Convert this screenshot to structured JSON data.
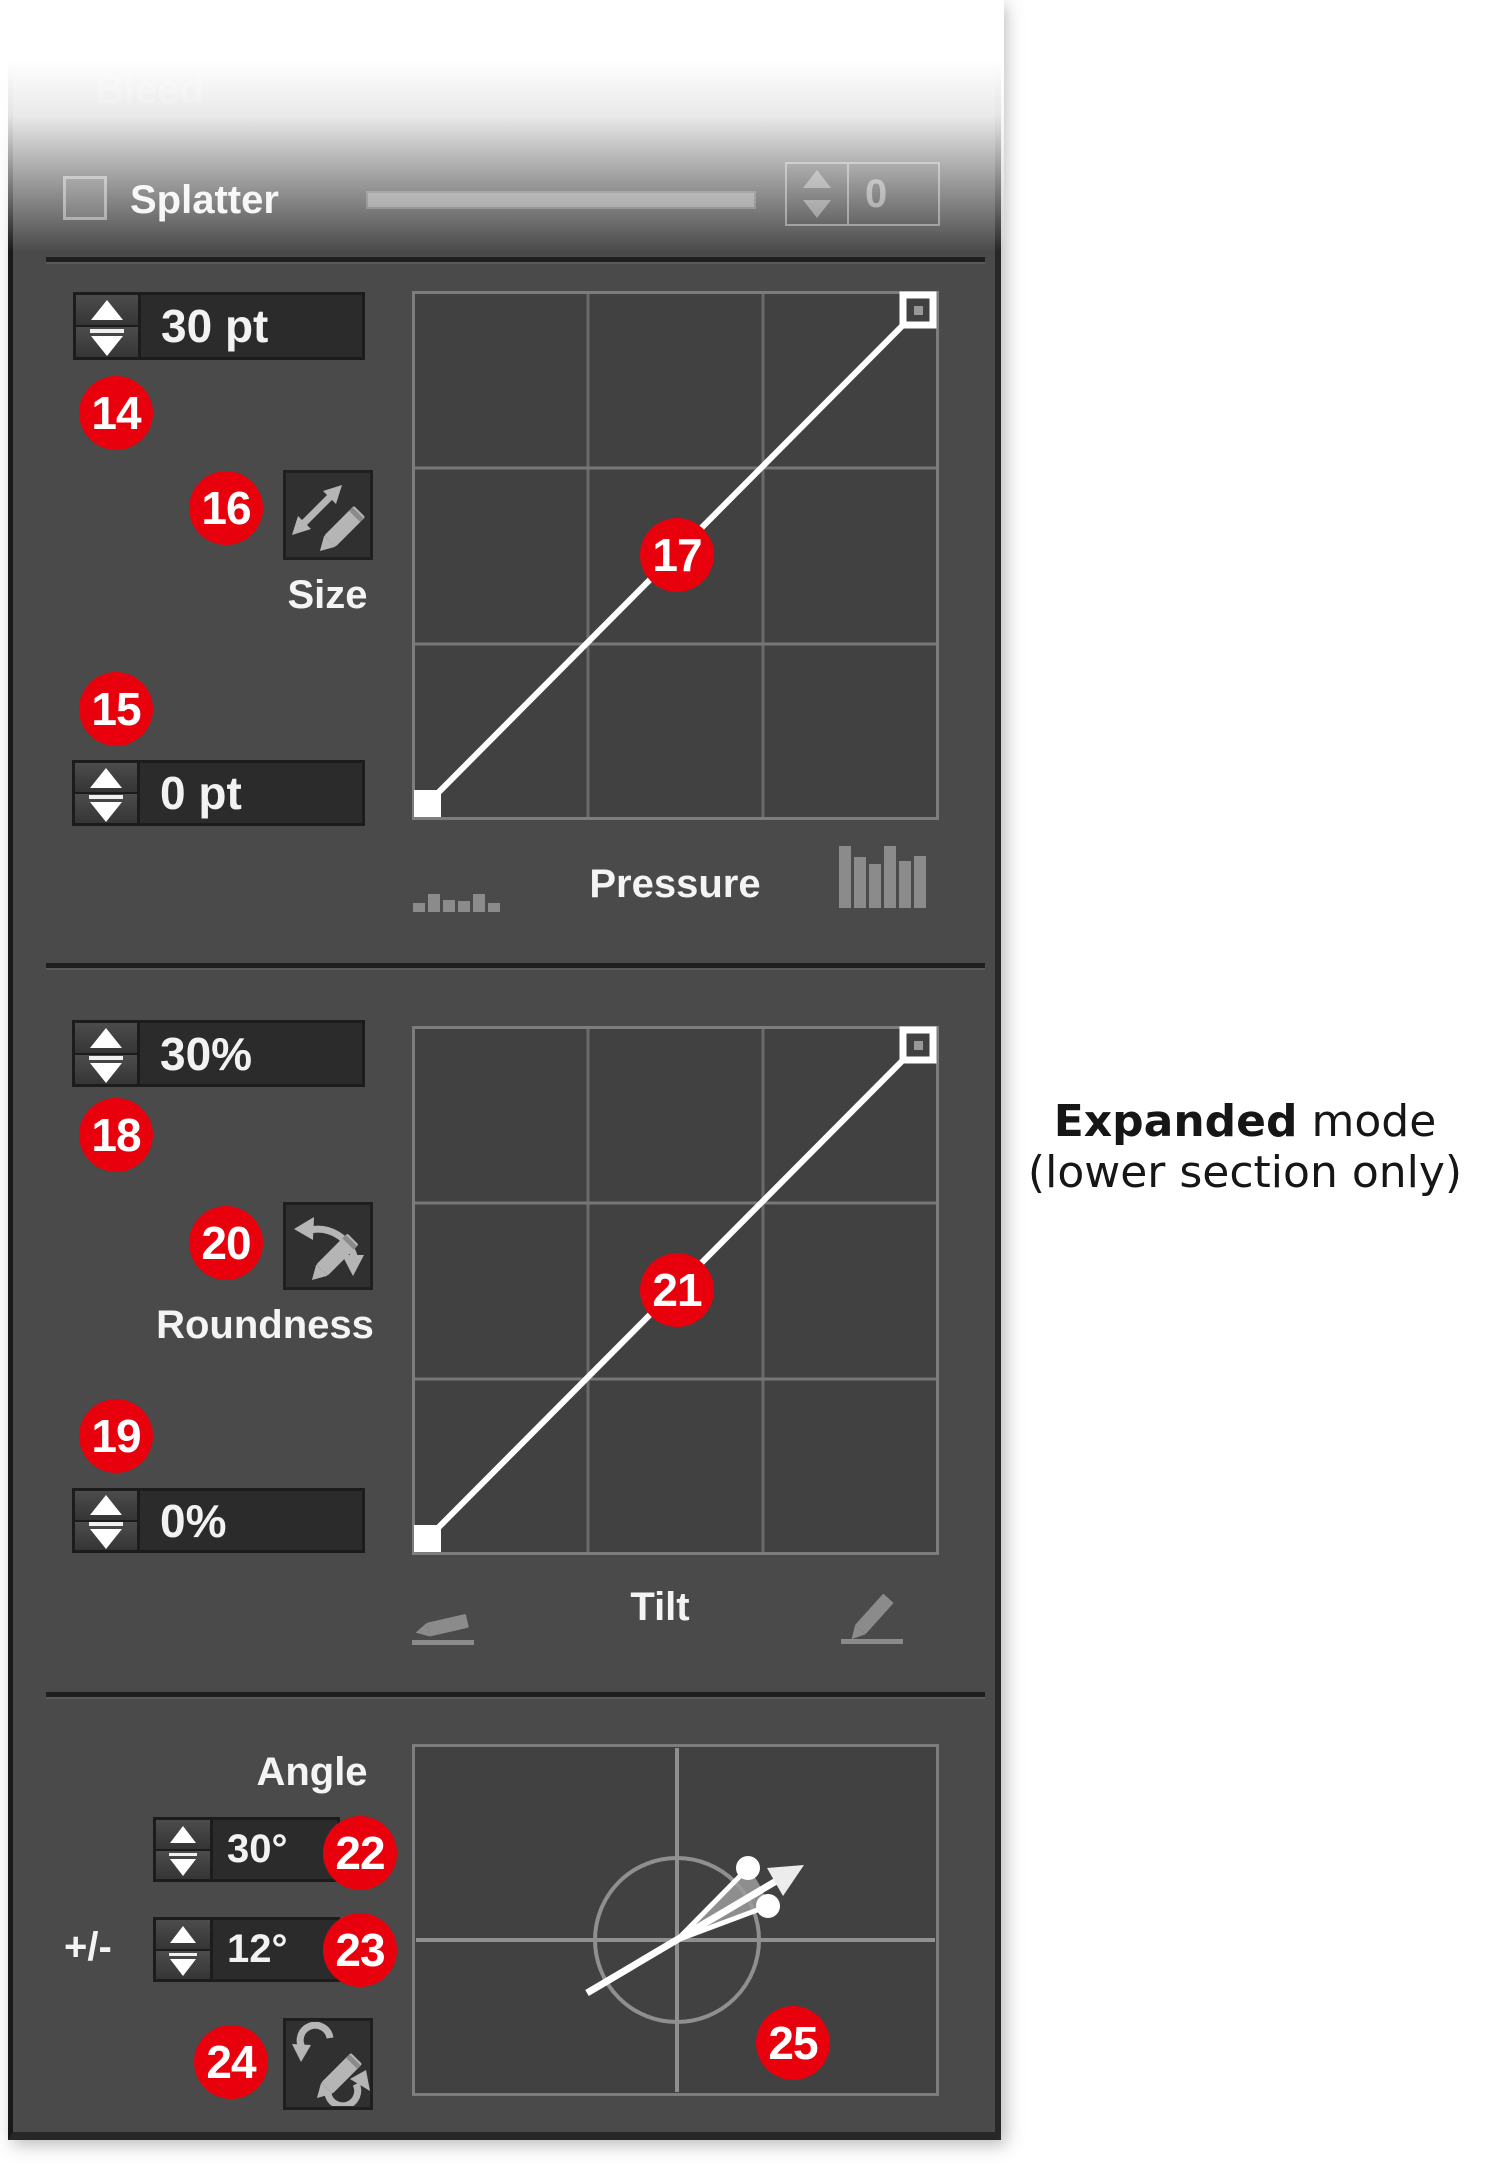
{
  "panel": {
    "faded_top": {
      "bleed_label": "Bleed",
      "splatter_label": "Splatter",
      "splatter_value": "0"
    },
    "size_section": {
      "max_value": "30 pt",
      "min_value": "0 pt",
      "button_label": "Size",
      "graph_label": "Pressure",
      "badges": {
        "max_stepper": "14",
        "min_stepper": "15",
        "dynamics_button": "16",
        "curve": "17"
      }
    },
    "roundness_section": {
      "max_value": "30%",
      "min_value": "0%",
      "button_label": "Roundness",
      "graph_label": "Tilt",
      "badges": {
        "max_stepper": "18",
        "min_stepper": "19",
        "dynamics_button": "20",
        "curve": "21"
      }
    },
    "angle_section": {
      "label": "Angle",
      "angle_value": "30°",
      "variance_prefix": "+/-",
      "variance_value": "12°",
      "badges": {
        "angle_stepper": "22",
        "variance_stepper": "23",
        "dynamics_button": "24",
        "dial": "25"
      }
    },
    "curves": {
      "pressure_curve": {
        "type": "linear",
        "from": [
          0,
          0
        ],
        "to": [
          1,
          1
        ]
      },
      "tilt_curve": {
        "type": "linear",
        "from": [
          0,
          0
        ],
        "to": [
          1,
          1
        ]
      },
      "angle_dial": {
        "angle_deg": 30,
        "variance_deg": 12
      }
    }
  },
  "annotation": {
    "bold": "Expanded",
    "rest": " mode",
    "line2": "(lower section only)"
  },
  "colors": {
    "badge_red": "#e8000d",
    "panel_bg": "#4a4a4a",
    "graph_bg": "#414141"
  }
}
